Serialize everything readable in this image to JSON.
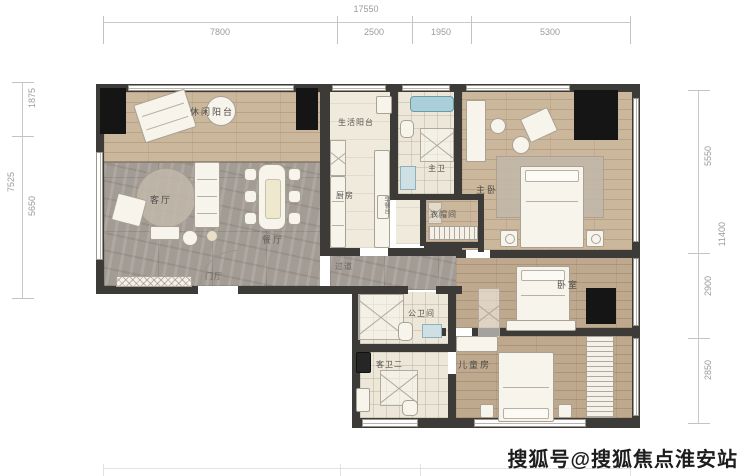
{
  "dimensions": {
    "top": {
      "total": "17550",
      "segments": [
        "7800",
        "2500",
        "1950",
        "5300"
      ]
    },
    "left": {
      "total": "7525",
      "segments": [
        "1875",
        "5650"
      ]
    },
    "right": {
      "total": "11400",
      "segments": [
        "5550",
        "2900",
        "2850"
      ]
    }
  },
  "rooms": {
    "leisure_balcony": "休闲阳台",
    "living_room": "客厅",
    "dining_room": "餐厅",
    "entry_hall": "门厅",
    "corridor": "过道",
    "service_balcony": "生活阳台",
    "kitchen": "厨房",
    "breakfast_bar": "早餐台",
    "master_bath": "主卫",
    "cloakroom": "衣帽间",
    "master_bedroom": "主卧",
    "bedroom": "卧室",
    "kids_room": "儿童房",
    "public_bath": "公卫间",
    "guest_bath_2": "客卫二"
  },
  "watermark": "搜狐号@搜狐焦点淮安站",
  "colors": {
    "wall": "#3d3b37",
    "wood_floor": "#cbb79c",
    "marble_floor": "#a29c94",
    "tile_floor": "#ece7d9",
    "bathtub": "#a9cfda",
    "dim_text": "#9b9b9b"
  }
}
